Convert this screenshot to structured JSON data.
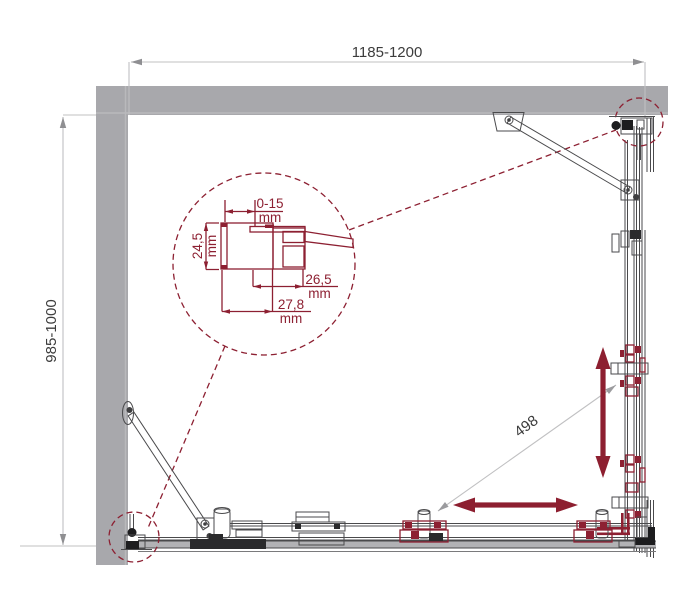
{
  "drawing": {
    "type": "shower-enclosure-plan-view",
    "dim_width": "1185-1200",
    "dim_depth": "985-1000",
    "dim_diagonal_opening": "498",
    "detail": {
      "wall_adjustment": "0-15",
      "profile_depth": "24,5",
      "profile_inner_width": "26,5",
      "profile_outer_width": "27,8",
      "unit": "mm"
    }
  },
  "colors": {
    "wall_gray": "#a8a8ac",
    "rail_gray": "#b2b2b5",
    "accent_red": "#8d2032",
    "arrow_red": "#8d1f30",
    "line_dark": "#4a4a4c",
    "dim_line_gray": "#c0c0c2",
    "text_dark": "#3c3c3c"
  }
}
